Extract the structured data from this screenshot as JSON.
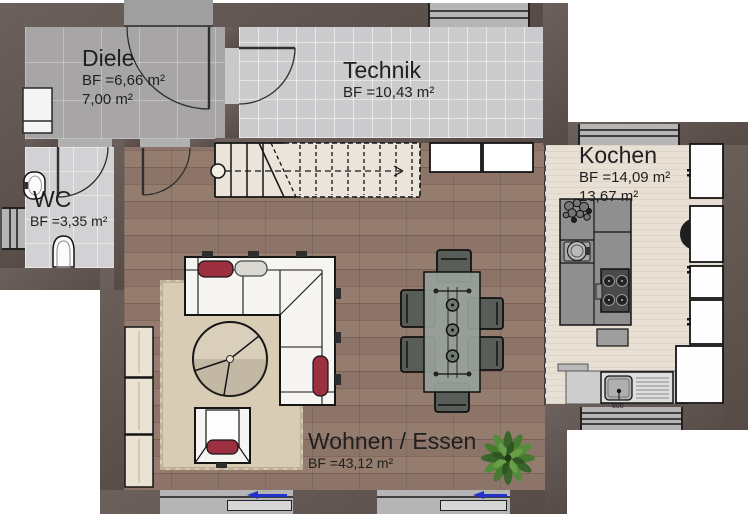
{
  "plan": {
    "rooms": [
      {
        "id": "diele",
        "name": "Diele",
        "areas": [
          "BF =6,66 m²",
          "7,00 m²"
        ]
      },
      {
        "id": "technik",
        "name": "Technik",
        "areas": [
          "BF =10,43 m²"
        ]
      },
      {
        "id": "wc",
        "name": "WC",
        "areas": [
          "BF =3,35 m²"
        ]
      },
      {
        "id": "kochen",
        "name": "Kochen",
        "areas": [
          "BF =14,09 m²",
          "13,67 m²"
        ]
      },
      {
        "id": "wohnen-essen",
        "name": "Wohnen / Essen",
        "areas": [
          "BF =43,12 m²"
        ]
      }
    ],
    "annotations": {
      "sink_dimension": "600"
    },
    "fixtures": [
      "entrance-door",
      "interior-doors",
      "staircase",
      "corner-sofa",
      "armchair",
      "coffee-table",
      "rug",
      "dining-table",
      "dining-chairs",
      "kitchen-island",
      "cooktop",
      "island-sink",
      "counter-sink",
      "tall-cabinets",
      "sideboard-cabinets",
      "hall-closets",
      "wardrobe",
      "toilet",
      "washbasin",
      "plant",
      "sliding-windows"
    ],
    "colors": {
      "wall": "#60534f",
      "wood_floor": "#8a7164",
      "kitchen_floor": "#e8e0d5",
      "tile_diele": "#a7a5a6",
      "tile_light": "#dadadc",
      "rug": "#d9ccb5",
      "cushion_red": "#9c3040",
      "arrow_blue": "#2233cc",
      "window_gray": "#b5b5b5",
      "cabinet_cream": "#eae2d3"
    }
  }
}
